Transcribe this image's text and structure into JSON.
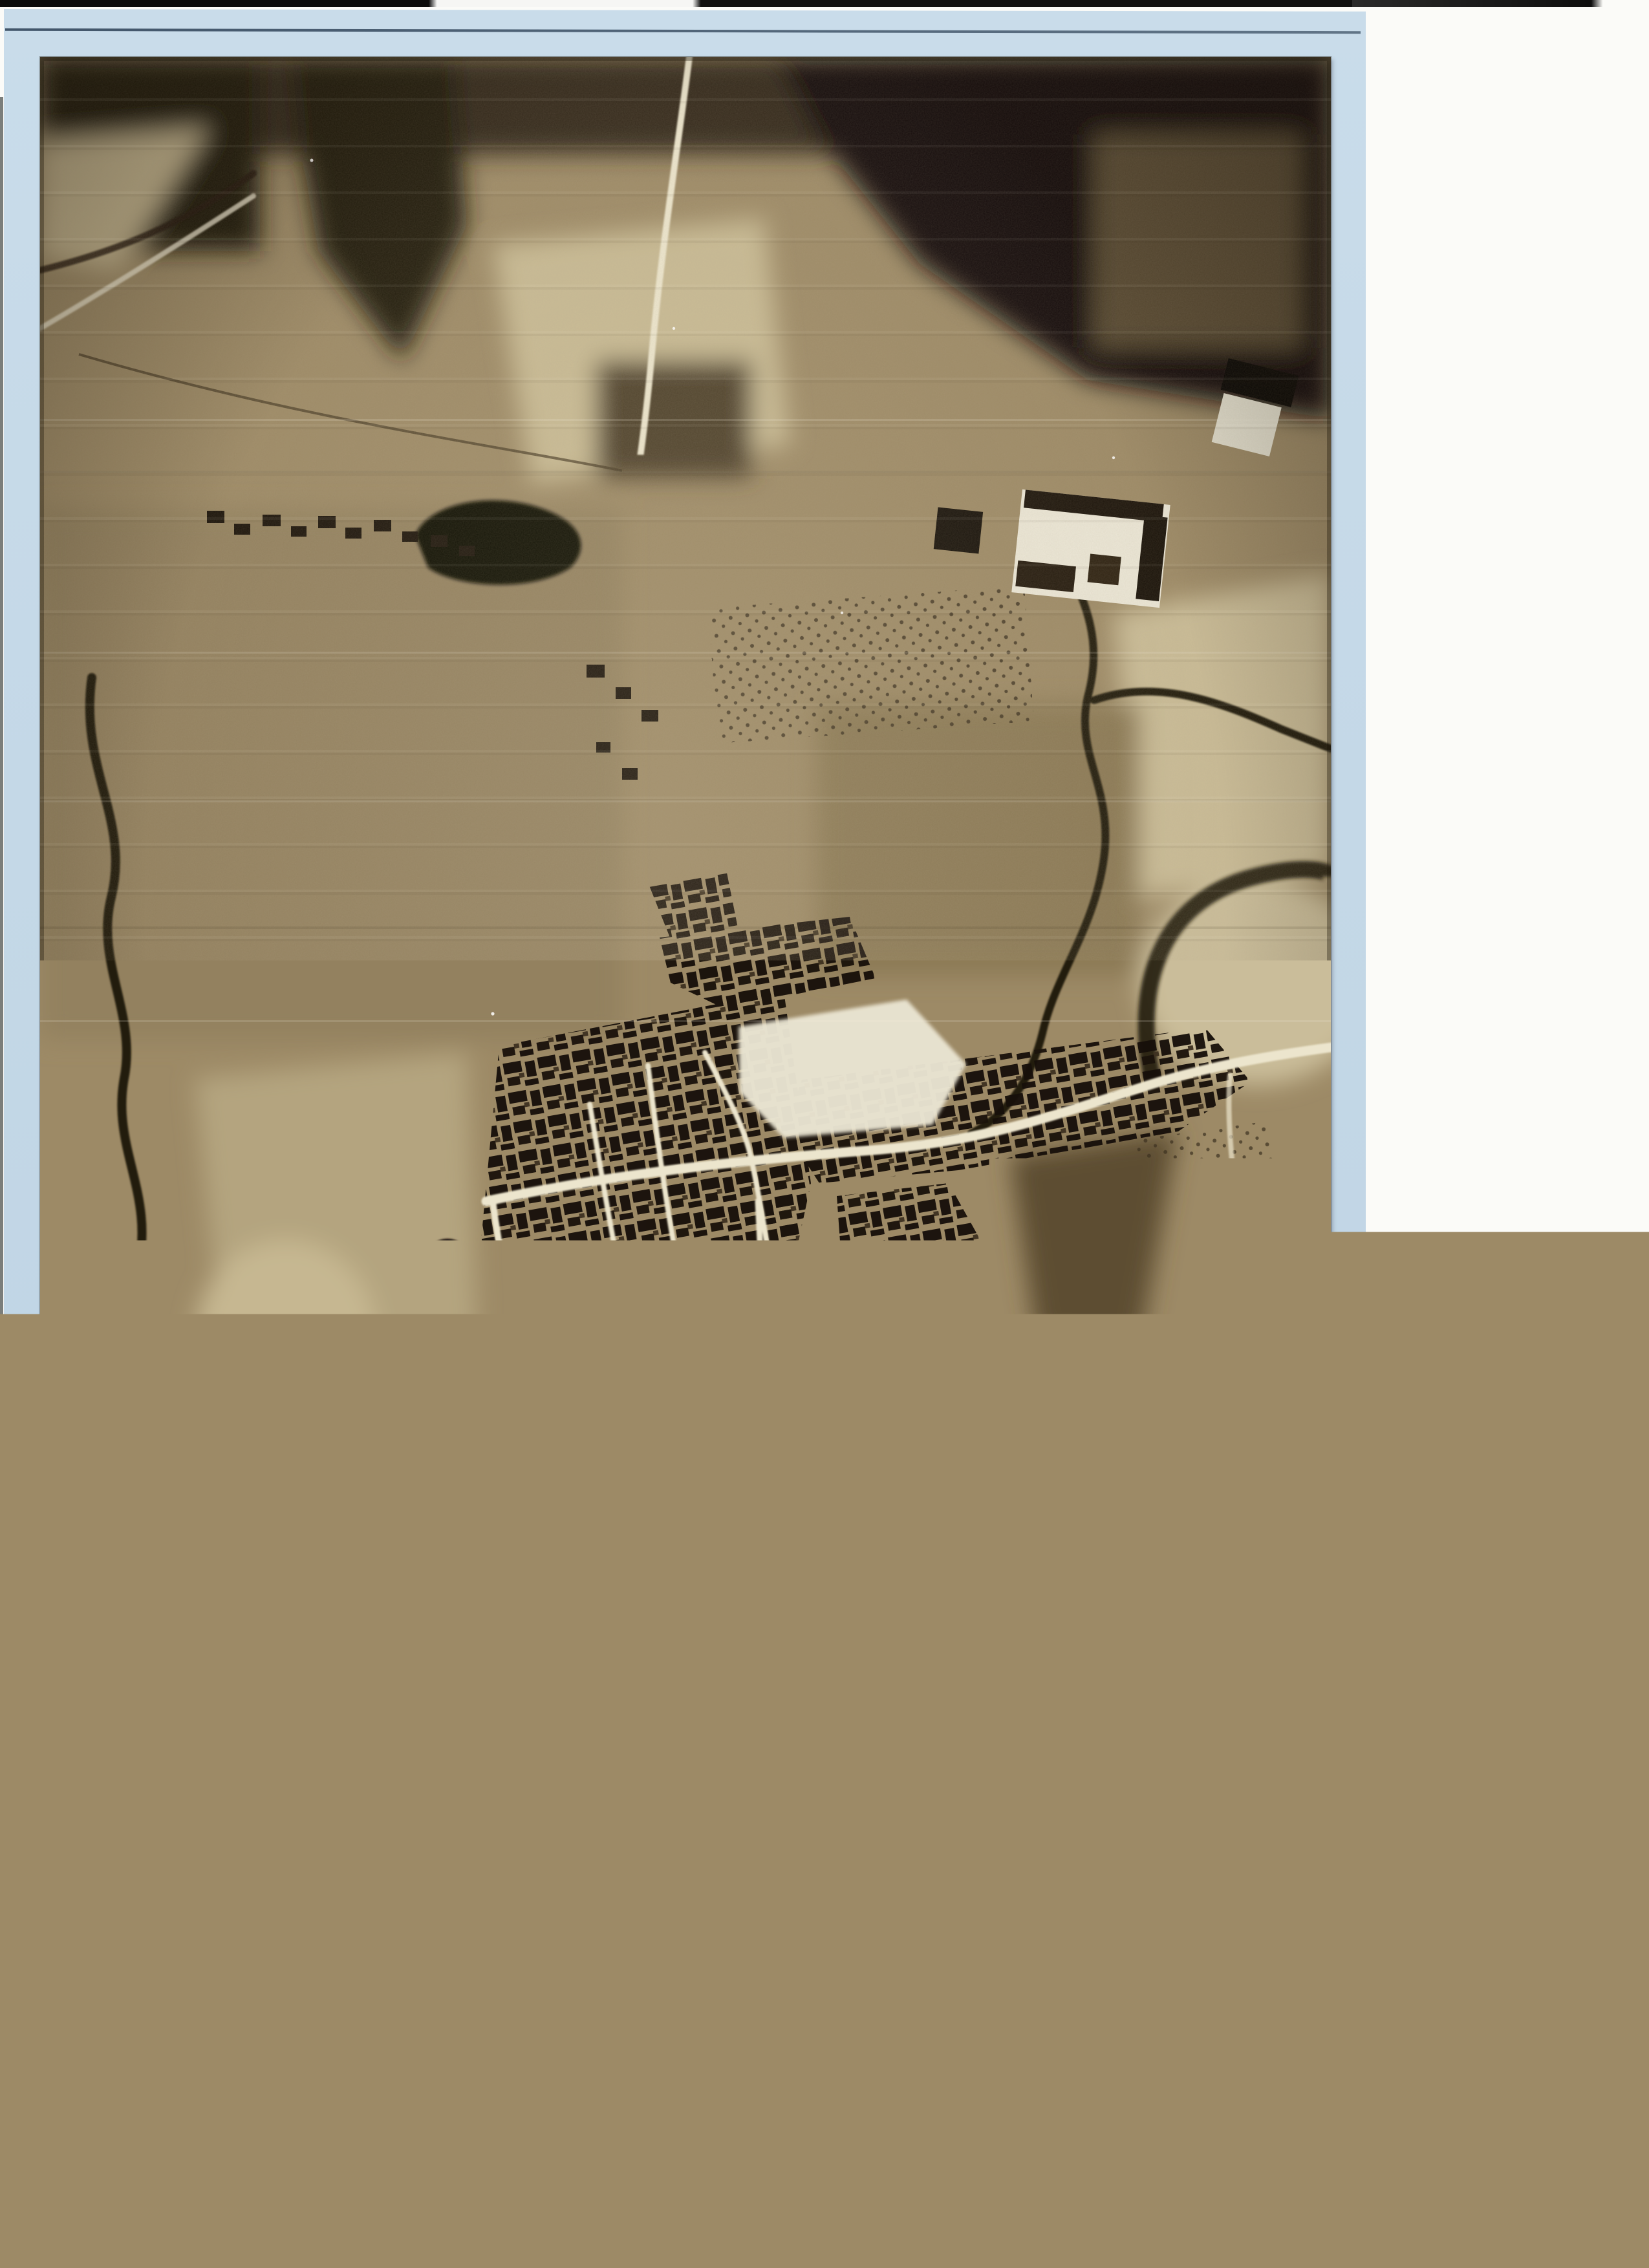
{
  "scan": {
    "caption": {
      "line1": "Luftbild von Flöhau, aufgenommen von einem",
      "line2": "amerikanischen Aufklärer im April 1945"
    },
    "page_number": "002",
    "photo": {
      "icons": {
        "north_arrow": "north-arrow-icon"
      }
    },
    "colors": {
      "page_blue": "#c4d8e7",
      "photo_sepia_base": "#9d8a66",
      "photo_dark": "#140f08",
      "photo_light": "#ece5cd",
      "handwriting_ink": "#27324a",
      "stamp_ink": "#17211f",
      "surround_white": "#fbfbf8"
    }
  }
}
